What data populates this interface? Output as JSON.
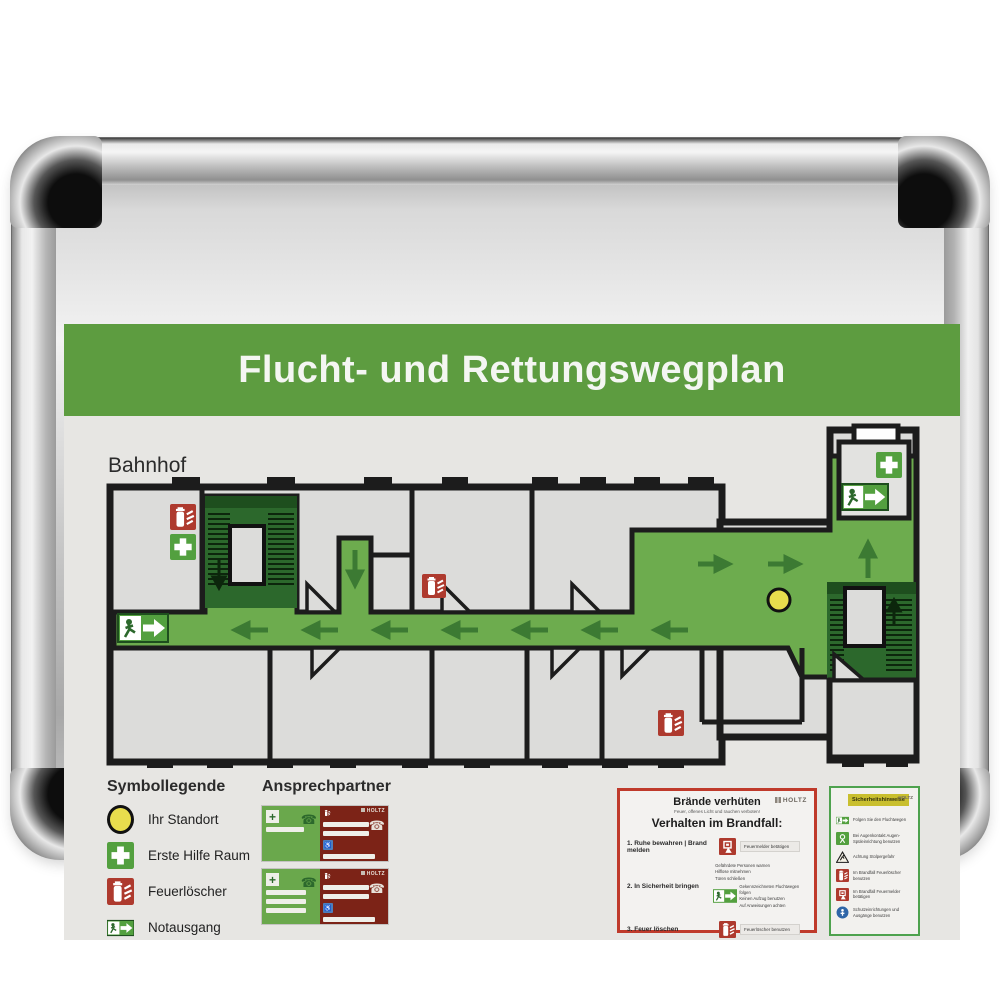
{
  "header": {
    "title": "Flucht- und Rettungswegplan"
  },
  "plan": {
    "location_label": "Bahnhof",
    "icons": [
      "fire-extinguisher-icon",
      "first-aid-icon",
      "emergency-exit-icon",
      "location-dot-icon",
      "stairs-icon",
      "elevator-icon",
      "route-arrow-icon"
    ]
  },
  "legend": {
    "title": "Symbollegende",
    "items": [
      {
        "icon": "location-dot-icon",
        "label": "Ihr Standort"
      },
      {
        "icon": "first-aid-icon",
        "label": "Erste Hilfe Raum"
      },
      {
        "icon": "fire-extinguisher-icon",
        "label": "Feuerlöscher"
      },
      {
        "icon": "emergency-exit-icon",
        "label": "Notausgang"
      }
    ]
  },
  "contacts": {
    "title": "Ansprechpartner",
    "brand": "HOLTZ"
  },
  "fire_panel": {
    "title": "Brände verhüten",
    "subtitle": "Feuer, offenes Licht und rauchen verboten!",
    "heading": "Verhalten im Brandfall:",
    "brand": "HOLTZ",
    "steps": [
      {
        "label": "1. Ruhe bewahren | Brand melden",
        "icon": "fire-alarm-icon",
        "note": "Feuermelder betätigen"
      },
      {
        "label": "2. In Sicherheit bringen",
        "icon": "emergency-exit-icon",
        "notes_before": [
          "Gefährdete Personen warnen",
          "Hilflose mitnehmen",
          "Türen schließen"
        ],
        "notes_after": [
          "Gekennzeichneten Fluchtwegen folgen",
          "Keinen Aufzug benutzen",
          "Auf Anweisungen achten"
        ]
      },
      {
        "label": "3. Feuer löschen",
        "icon": "fire-extinguisher-icon",
        "note": "Feuerlöscher benutzen"
      }
    ]
  },
  "safety_panel": {
    "title": "Sicherheitshinweise",
    "brand": "HOLTZ",
    "rows": [
      {
        "icon": "emergency-exit-icon",
        "text": "Folgen Sie den Fluchtwegen"
      },
      {
        "icon": "eye-wash-icon",
        "text": "Bei Augenkontakt Augen-Spüleinrichtung benutzen"
      },
      {
        "icon": "warning-icon",
        "text": "Achtung Stolpergefahr"
      },
      {
        "icon": "fire-extinguisher-icon",
        "text": "Im Brandfall Feuerlöscher benutzen"
      },
      {
        "icon": "fire-alarm-icon",
        "text": "Im Brandfall Feuermelder betätigen"
      },
      {
        "icon": "mandatory-icon",
        "text": "Schutzeinrichtungen und Ausgänge benutzen"
      }
    ]
  },
  "colors": {
    "header_green": "#5d9c40",
    "route_green": "#6dac4e",
    "stair_green": "#2c682c",
    "sign_green": "#53a03f",
    "fire_red": "#ae3a2e",
    "contact_red": "#7c2317",
    "location_yellow": "#e8dd4d",
    "board_gray": "#e7e6e3",
    "wall_black": "#1c1c1c",
    "frame_silver": "#c9c9c9"
  }
}
